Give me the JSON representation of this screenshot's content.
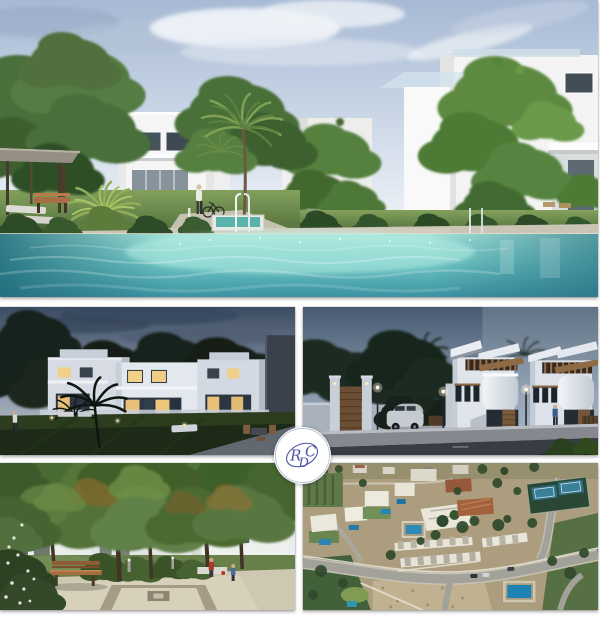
{
  "meta": {
    "type": "real-estate photo collage",
    "background": "#ffffff"
  },
  "logo": {
    "monogram": "RDC",
    "letters": {
      "r": "R",
      "d": "D",
      "c": "C"
    },
    "ink_color": "#4d52a2",
    "badge_color": "#ffffff",
    "ring_color": "#bfc4d8"
  },
  "gallery": {
    "layout": "hero image above 2x2 grid with centered logo badge",
    "panels": [
      {
        "id": "pool-daylight",
        "description": "Daytime render of communal swimming pool with modern white villas, ivy-covered facades, trees, pergola and sun loungers"
      },
      {
        "id": "villas-dusk",
        "description": "Dusk render of two-storey white villas with lit windows, lawn and palm tree"
      },
      {
        "id": "street-dusk",
        "description": "Dusk street view of white townhouses with wood details, entrance gate and parked car"
      },
      {
        "id": "courtyard-day",
        "description": "Daytime render of landscaped courtyard with mature trees, wooden bench and paved plaza"
      },
      {
        "id": "aerial-view",
        "description": "Aerial photo of residential development with white villas, pools, curving road and tennis courts"
      }
    ]
  },
  "palette": {
    "day_sky": "#c3d1e3",
    "pool_water": "#6fc6c4",
    "dusk_sky": "#51627a",
    "foliage": "#4c6e3a",
    "aerial_ground": "#ab9d7e"
  }
}
